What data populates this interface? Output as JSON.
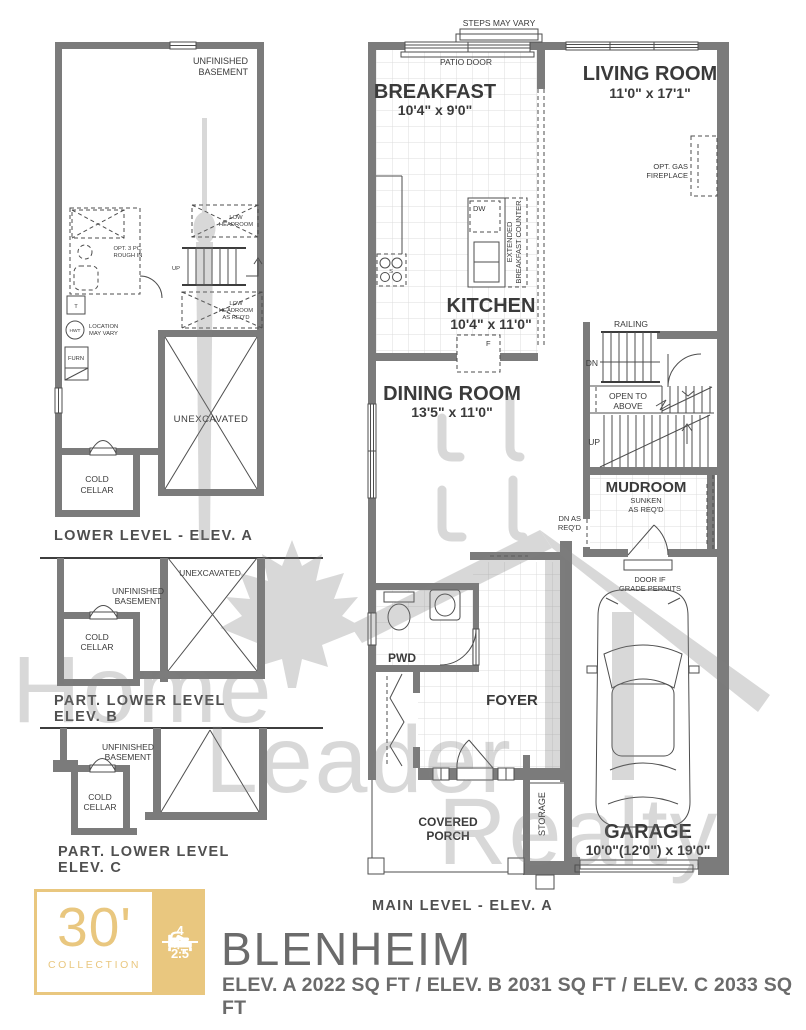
{
  "footer": {
    "collection_number": "30'",
    "collection_label": "COLLECTION",
    "beds_count": "4",
    "baths_count": "2.5",
    "model_name": "BLENHEIM",
    "sqft_summary": "ELEV. A 2022 SQ FT / ELEV. B 2031 SQ FT / ELEV. C 2033 SQ FT",
    "accent_gold": "#e9c77f",
    "text_gray": "#6b6b6b"
  },
  "watermark": {
    "word1": "Home",
    "word2": "Leader",
    "word3": "Realty"
  },
  "main_level": {
    "caption": "MAIN LEVEL - ELEV. A",
    "steps_note": "STEPS MAY VARY",
    "patio_door": "PATIO DOOR",
    "breakfast": {
      "name": "BREAKFAST",
      "dims": "10'4\" x 9'0\""
    },
    "living_room": {
      "name": "LIVING ROOM",
      "dims": "11'0\" x 17'1\""
    },
    "fireplace": [
      "OPT. GAS",
      "FIREPLACE"
    ],
    "kitchen": {
      "name": "KITCHEN",
      "dims": "10'4\" x 11'0\""
    },
    "dw": "DW",
    "extended_counter": [
      "EXTENDED",
      "BREAKFAST COUNTER"
    ],
    "stove": "S",
    "fridge": "F",
    "railing": "RAILING",
    "dn": "DN",
    "up": "UP",
    "open_to_above": [
      "OPEN TO",
      "ABOVE"
    ],
    "dining_room": {
      "name": "DINING ROOM",
      "dims": "13'5\" x 11'0\""
    },
    "mudroom": {
      "name": "MUDROOM",
      "note1": "SUNKEN",
      "note2": "AS REQ'D"
    },
    "dn_as_reqd": [
      "DN AS",
      "REQ'D"
    ],
    "door_grade": [
      "DOOR IF",
      "GRADE PERMITS"
    ],
    "pwd": "PWD",
    "foyer": "FOYER",
    "covered_porch": [
      "COVERED",
      "PORCH"
    ],
    "storage": "STORAGE",
    "garage": {
      "name": "GARAGE",
      "dims": "10'0\"(12'0\") x 19'0\""
    }
  },
  "lower_level_a": {
    "caption": "LOWER LEVEL - ELEV. A",
    "unfinished_basement": [
      "UNFINISHED",
      "BASEMENT"
    ],
    "opt_rough_in": [
      "OPT. 3 PC.",
      "ROUGH IN"
    ],
    "low_headroom": [
      "LOW",
      "HEADROOM"
    ],
    "up": "UP",
    "low_headroom_reqd": [
      "LOW",
      "HEADROOM",
      "AS REQ'D"
    ],
    "tank": "T",
    "hwt": "HWT",
    "hwt_note": [
      "LOCATION",
      "MAY VARY"
    ],
    "furnace": "FURN",
    "unexcavated": "UNEXCAVATED",
    "cold_cellar": [
      "COLD",
      "CELLAR"
    ]
  },
  "part_lower_b": {
    "caption": [
      "PART. LOWER LEVEL",
      "ELEV. B"
    ],
    "unexcavated": "UNEXCAVATED",
    "unfinished_basement": [
      "UNFINISHED",
      "BASEMENT"
    ],
    "cold_cellar": [
      "COLD",
      "CELLAR"
    ]
  },
  "part_lower_c": {
    "caption": [
      "PART. LOWER LEVEL",
      "ELEV. C"
    ],
    "unfinished_basement": [
      "UNFINISHED",
      "BASEMENT"
    ],
    "cold_cellar": [
      "COLD",
      "CELLAR"
    ]
  }
}
